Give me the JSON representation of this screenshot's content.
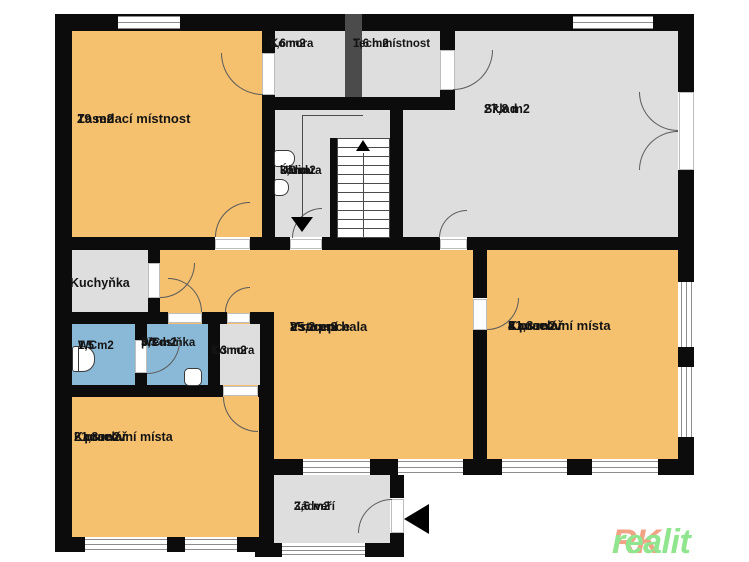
{
  "colors": {
    "wall": "#0c0c0c",
    "room-orange": "#f5c16f",
    "room-gray": "#dedede",
    "room-blue": "#8ab9d8",
    "column-dark": "#4b4b4b",
    "rk-orange": "#f2a385",
    "rk-green": "#8fe68f"
  },
  "branding": {
    "logo_top_line1": "Loved",
    "logo_top_line2": "Realit",
    "logo_rk": "RK",
    "logo_realit": "realit"
  },
  "rooms": {
    "zasedaci": {
      "name": "Zasedací místnost",
      "area": "19 m2"
    },
    "komora_top": {
      "name": "Komora",
      "area": "1,6 m2"
    },
    "tech": {
      "name": "Tech.místnost",
      "area": "1,6 m2"
    },
    "sklad": {
      "name": "Sklad",
      "area": "27,8 m2"
    },
    "uklid": {
      "name": "Úklid.",
      "name2": "komora",
      "area": "3,9 m2"
    },
    "kuchynka": {
      "name": "Kuchyňka"
    },
    "wc": {
      "name": "WC",
      "area": "1,5 m2"
    },
    "predsinka": {
      "name": "WC",
      "name2": "předsíňka",
      "area": "3,3 m2"
    },
    "komora_mala": {
      "name": "Komora",
      "area": "1,3 m2"
    },
    "hala": {
      "name": "Vstupní hala",
      "name2": "a recepce",
      "area": "25,2 m2"
    },
    "kancelar4": {
      "name": "Kancelář",
      "name2": "4 pracovní místa",
      "area": "21,3 m2"
    },
    "kancelar2": {
      "name": "Kancelář",
      "name2": "2 pracovní místa",
      "area": "21,3 m2"
    },
    "zadveri": {
      "name": "Zádveří",
      "area": "3,6 m2"
    }
  }
}
